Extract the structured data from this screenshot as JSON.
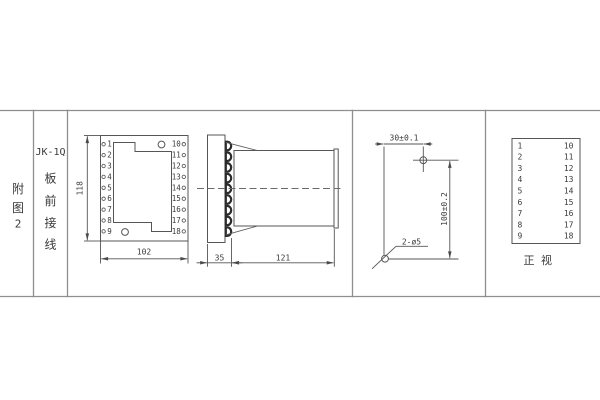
{
  "drawing": {
    "figure_label": [
      "附",
      "图",
      "2"
    ],
    "model": "JK-1Q",
    "mounting_label": [
      "板",
      "前",
      "接",
      "线"
    ],
    "front_view": {
      "left_terminals": [
        "1",
        "2",
        "3",
        "4",
        "5",
        "6",
        "7",
        "8",
        "9"
      ],
      "right_terminals": [
        "10",
        "11",
        "12",
        "13",
        "14",
        "15",
        "16",
        "17",
        "18"
      ],
      "height_dim": "118",
      "width_dim": "102"
    },
    "side_view": {
      "depth_dim": "35",
      "length_dim": "121"
    },
    "drill_pattern": {
      "horizontal_dim": "30±0.1",
      "vertical_dim": "100±0.2",
      "holes_label": "2-ø5"
    },
    "terminal_table": {
      "left": [
        "1",
        "2",
        "3",
        "4",
        "5",
        "6",
        "7",
        "8",
        "9"
      ],
      "right": [
        "10",
        "11",
        "12",
        "13",
        "14",
        "15",
        "16",
        "17",
        "18"
      ],
      "caption": [
        "正",
        "视"
      ]
    }
  },
  "colors": {
    "background": "#ffffff",
    "line": "#565656",
    "border": "#8f8f8f",
    "text": "#3a3a3a",
    "terminal_dark": "#2b2b2b"
  }
}
